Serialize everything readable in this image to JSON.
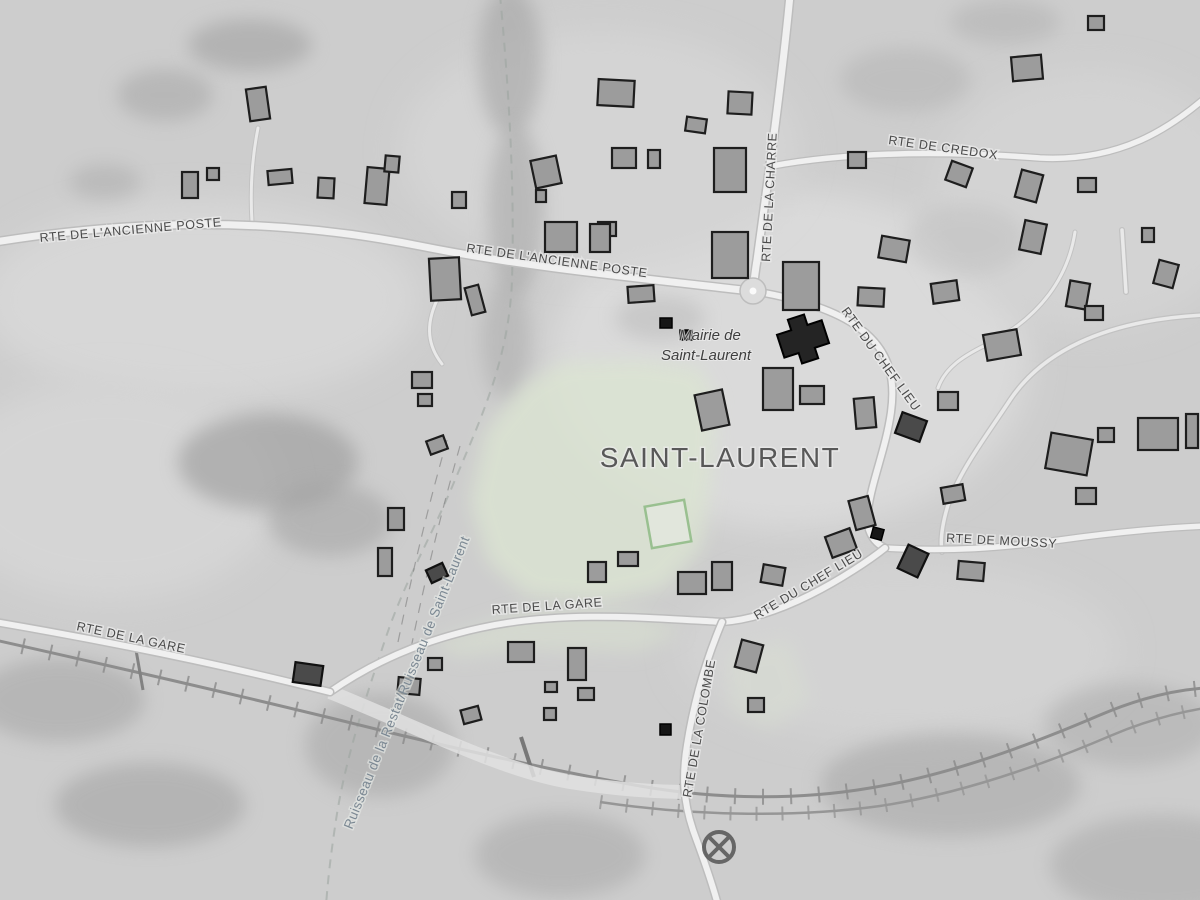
{
  "map": {
    "place_title": "SAINT-LAURENT",
    "poi": {
      "mairie_line1": "Mairie de",
      "mairie_line2": "Saint-Laurent"
    },
    "roads": {
      "ancienne_poste_left": "RTE DE L'ANCIENNE POSTE",
      "ancienne_poste_center": "RTE DE L'ANCIENNE POSTE",
      "credox": "RTE DE CREDOX",
      "la_charre": "RTE DE LA CHARRE",
      "chef_lieu_upper": "RTE DU CHEF LIEU",
      "chef_lieu_lower": "RTE DU CHEF LIEU",
      "moussy": "RTE DE MOUSSY",
      "la_gare_center": "RTE DE LA GARE",
      "la_gare_left": "RTE DE LA GARE",
      "la_colombe": "RTE DE LA COLOMBE"
    },
    "water": {
      "ruisseau": "Ruisseau de la Restat/Ruisseau de Saint-Laurent"
    },
    "symbols": {
      "level_crossing": "crossed-circle"
    },
    "colors": {
      "green_area": "#dbe4d2",
      "pitch_outline": "#8fbb85",
      "road_fill": "#f0f0f0",
      "building_fill": "#9c9c9c",
      "label_text": "#4a4a4a",
      "water_label_text": "#7b8893",
      "railway": "#8d8d8d"
    }
  }
}
